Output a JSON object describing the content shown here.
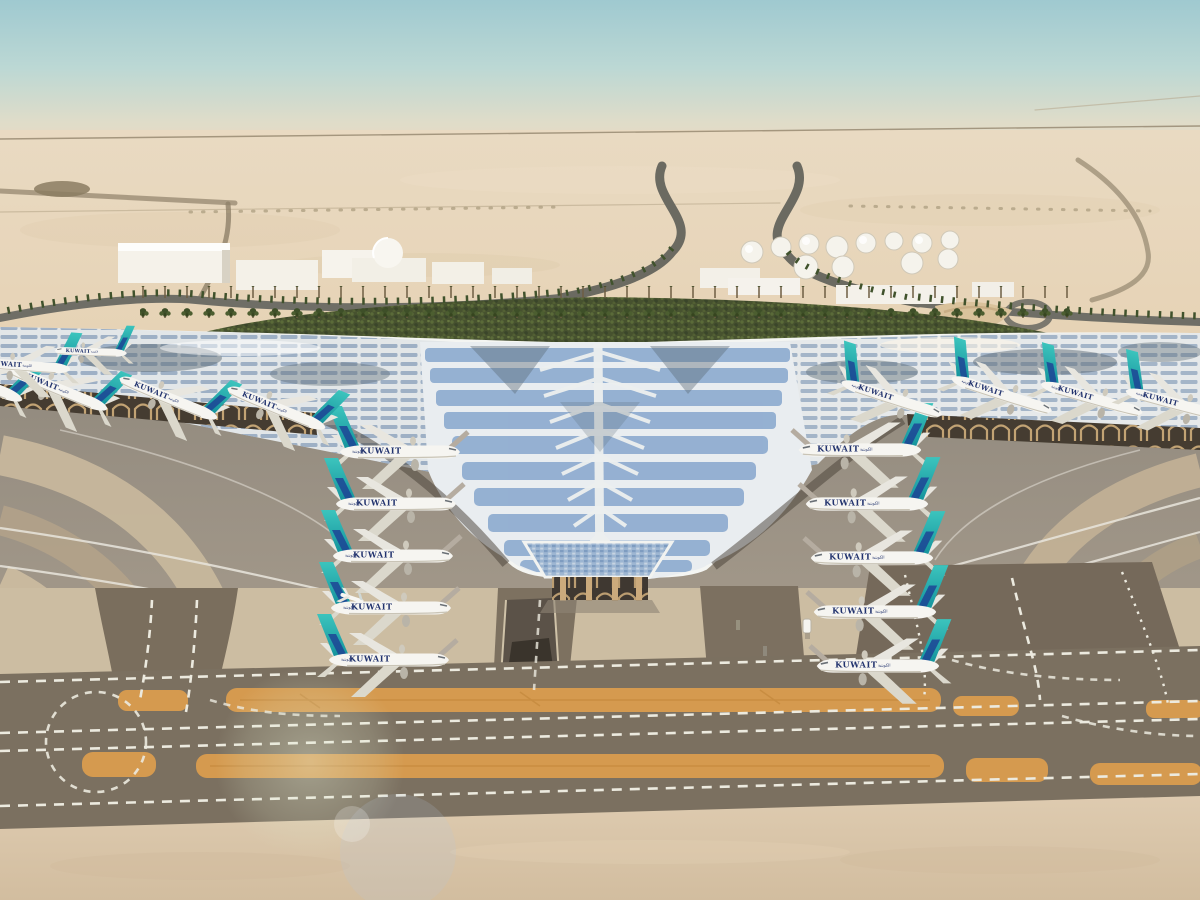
{
  "scene": {
    "description": "Aerial architectural rendering of a desert airport: a vast white trefoil canopy terminal with blue solar-panel chevrons, Kuwait-liveried aircraft parked nose-in at both piers and along the central V notch, grey aprons with curved taxi lines, ochre runway shoulder strips and dashed taxiway markings in the foreground, palm-lined access roads, a green landscaped wedge, white warehouses, a domed building and a white fuel-tank farm on the hazy horizon",
    "airline_title": "KUWAIT",
    "airline_title_arabic": "الكويتية",
    "aircraft": {
      "left_column": 5,
      "right_column": 5,
      "left_pier": 4,
      "right_pier": 4,
      "far_left_gates": 2,
      "total": 20,
      "livery": "white fuselage, teal tail with navy swoosh"
    },
    "landscape": {
      "fuel_tanks": 12,
      "warehouses": 8,
      "dome_buildings": 1,
      "palm_rows": 3,
      "green_strip": true,
      "tunnel_ramp": true,
      "service_vehicle": 1,
      "small_jet_on_apron": 1
    },
    "palette": {
      "sky_top": "#9fc9d0",
      "sky_horizon": "#ead9c2",
      "desert": "#e6d2b4",
      "road": "#6b6a61",
      "green_strip": "#47522f",
      "roof_white": "#e9edf0",
      "solar_blue": "#87a6cd",
      "roof_sheen": "#5c6b76",
      "canopy_shadow": "#453c31",
      "arch_tan": "#c9a878",
      "apron_grey": "#9a9184",
      "apron_sand_band": "#c7b79c",
      "taxiway_dark": "#7b7060",
      "concrete_pad": "#ccbda2",
      "runway_strip_orange": "#d59a4f",
      "marking_white": "#eceadf",
      "bottom_sand": "#dccab0",
      "tail_teal": "#2bb7b2",
      "swoosh_navy": "#1d3f93"
    }
  }
}
